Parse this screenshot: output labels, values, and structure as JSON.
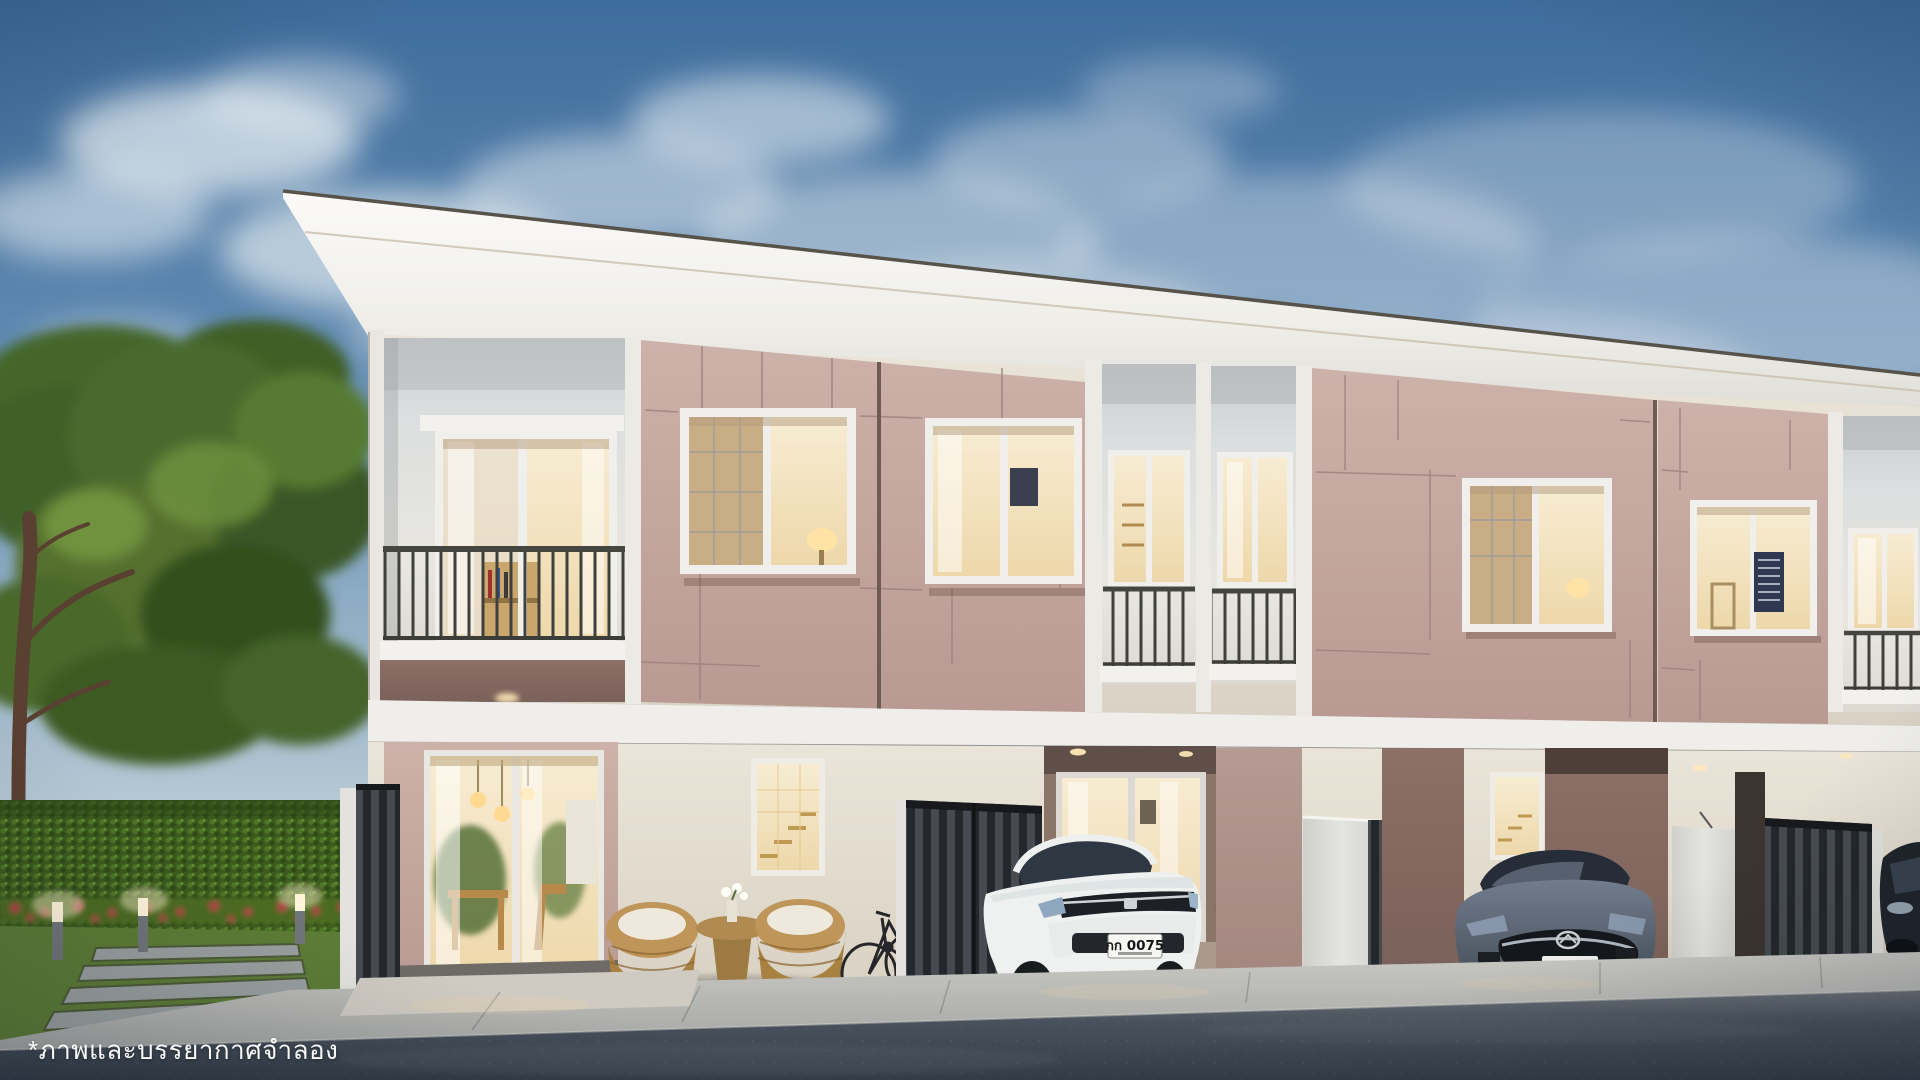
{
  "texts": {
    "disclaimer": "*ภาพและบรรยากาศจำลอง",
    "honda_license_plate": "กก 0075"
  },
  "scene": {
    "subject": "two-story townhouse row at dusk",
    "left_landscape": [
      "large trees",
      "green hedge wall",
      "red flower strip",
      "lawn with stepping stones",
      "3 lit bollard lights"
    ],
    "vehicles": [
      "white sedan in carport",
      "gray sedan in carport",
      "dark car partially visible at right edge"
    ],
    "foreground": [
      "concrete walkway",
      "asphalt road"
    ],
    "details": [
      "wicker patio chairs and table",
      "road bicycle against wall",
      "dark folding carport gates",
      "white gate panels",
      "warm-lit interiors"
    ]
  },
  "palette": {
    "sky_top": "#3e6c9c",
    "sky_horizon": "#d6dfe3",
    "cloud_white": "#edf2f5",
    "fascia_white": "#f2f1ed",
    "facade_cream": "#ece6da",
    "facade_mauve": "#c3a49c",
    "mauve_shadow": "#8a7068",
    "window_frame_white": "#f1efec",
    "warm_window_glow": "#f4dfae",
    "railing_dark": "#3f403c",
    "gate_dark": "#2b2e33",
    "gate_panel_white": "#dededa",
    "hedge_green": "#46661f",
    "flower_red": "#b53a48",
    "grass_green": "#5d7c36",
    "tree_green": "#4a6b2f",
    "trunk_brown": "#5a4030",
    "honda_white": "#eff1f0",
    "mazda_gray": "#5a6473",
    "dark_car": "#20242b",
    "road_asphalt": "#3a434f",
    "walkway_gray": "#b7b8b4"
  }
}
